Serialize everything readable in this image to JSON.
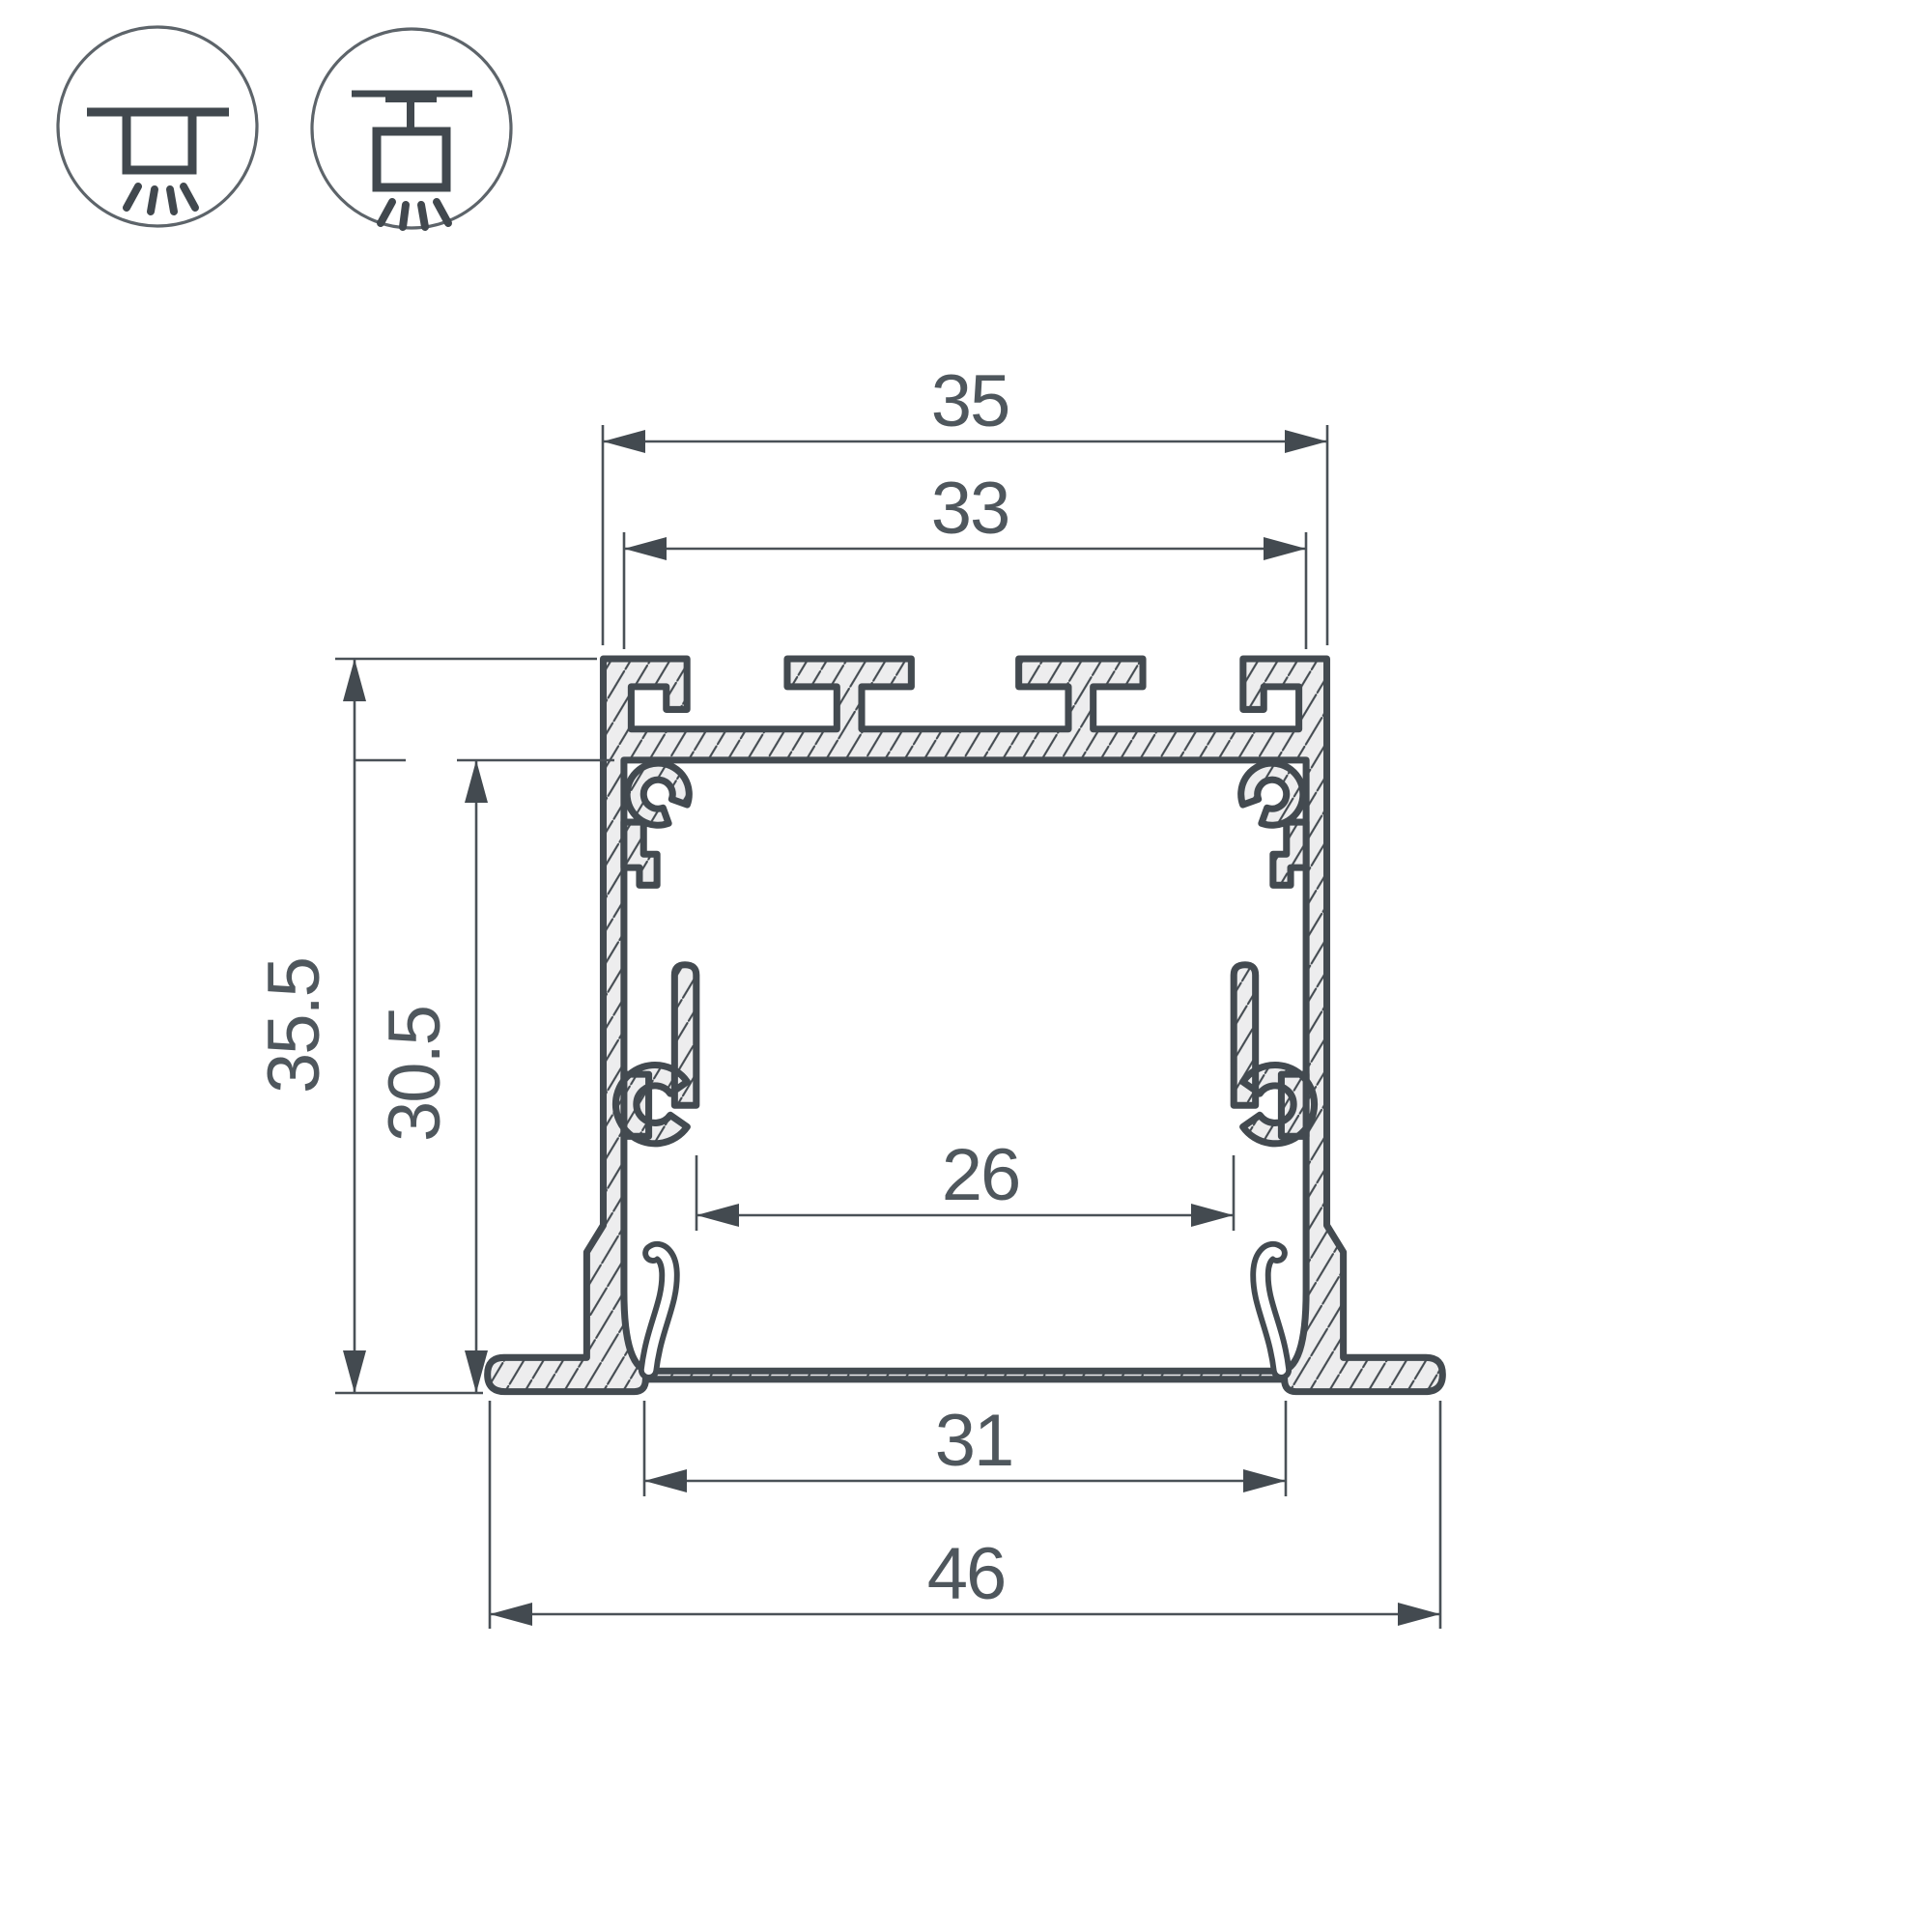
{
  "page": {
    "background_color": "#ffffff",
    "line_color": "#434a50",
    "thin_line_color": "#4a5157",
    "metal_fill_color": "#ededee",
    "text_color": "#4f575d"
  },
  "icons": [
    {
      "name": "recessed-mount-icon",
      "meaning": "recessed ceiling installation"
    },
    {
      "name": "surface-mount-icon",
      "meaning": "surface / pendant installation"
    }
  ],
  "diagram": {
    "type": "aluminium-profile-cross-section",
    "dimensions": {
      "top_width": "35",
      "inner_top_width": "33",
      "overall_height": "35.5",
      "inner_height": "30.5",
      "inner_width": "26",
      "bottom_opening": "31",
      "flange_width": "46"
    }
  }
}
